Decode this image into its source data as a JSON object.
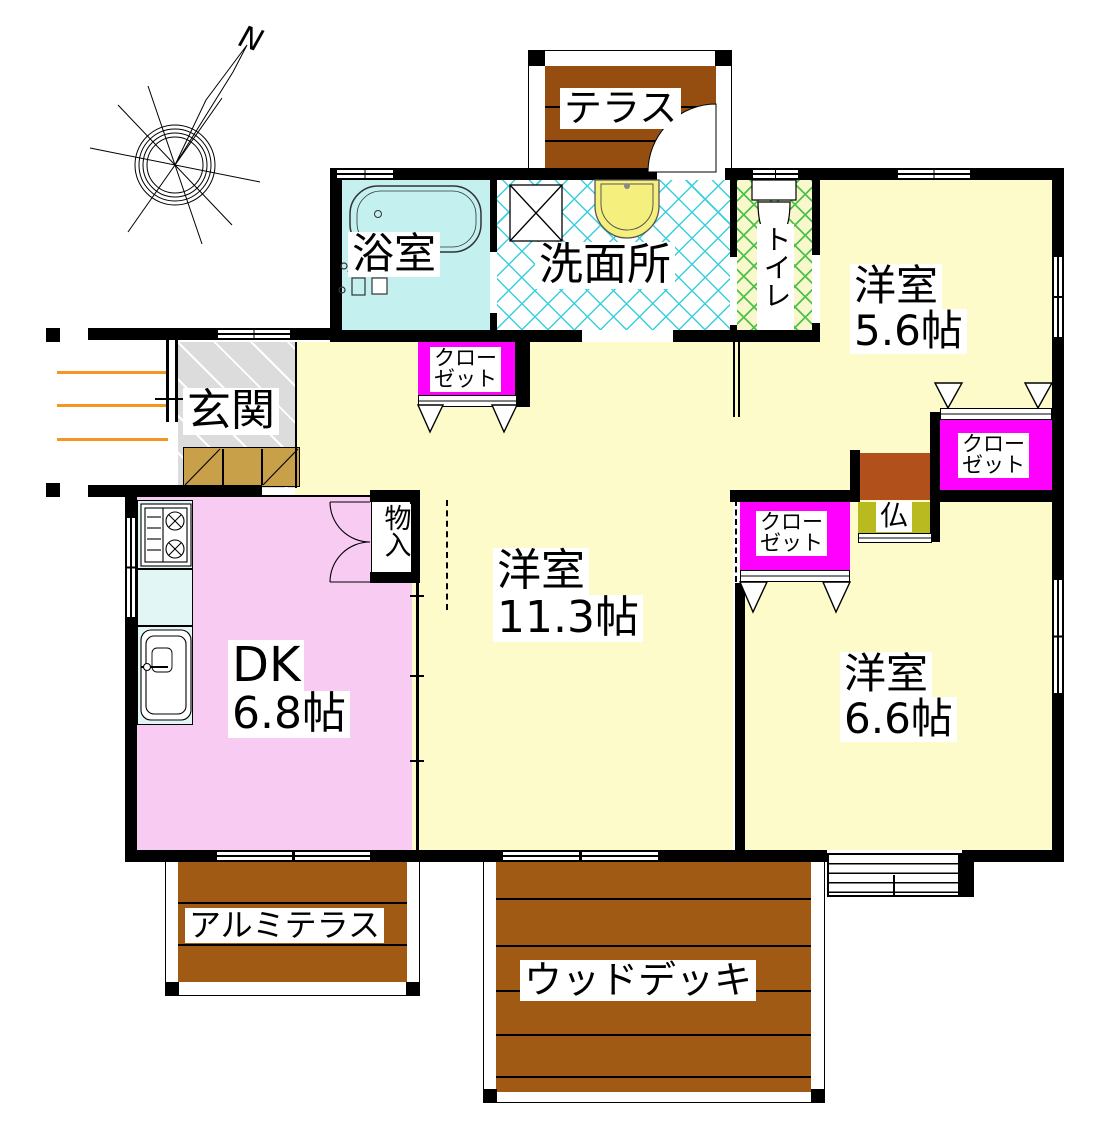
{
  "floorplan": {
    "compass": {
      "north_mark": "N"
    },
    "rooms": {
      "terrace": {
        "label": "テラス"
      },
      "bath": {
        "label": "浴室"
      },
      "washroom": {
        "label": "洗面所"
      },
      "toilet": {
        "label": "トイレ"
      },
      "room56": {
        "name": "洋室",
        "size": "5.6帖"
      },
      "entrance": {
        "label": "玄関"
      },
      "closet_113": {
        "line1": "クロー",
        "line2": "ゼット"
      },
      "closet_56": {
        "line1": "クロー",
        "line2": "ゼット"
      },
      "closet_66": {
        "line1": "クロー",
        "line2": "ゼット"
      },
      "storage": {
        "label": "物入"
      },
      "room113": {
        "name": "洋室",
        "size": "11.3帖"
      },
      "dk": {
        "name": "DK",
        "size": "6.8帖"
      },
      "butsudan": {
        "label": "仏"
      },
      "room66": {
        "name": "洋室",
        "size": "6.6帖"
      },
      "alumi_terrace": {
        "label": "アルミテラス"
      },
      "wood_deck": {
        "label": "ウッドデッキ"
      }
    },
    "colors": {
      "room_yellow": "#FCFBC9",
      "dk_pink": "#F8CBF2",
      "bath_cyan": "#C4F0F0",
      "closet_magenta": "#FF00FF",
      "wood_brown": "#A05A14",
      "terrace_brown": "#964E10",
      "butsudan_olive": "#B9B920",
      "entrance_gray": "#DCDCDC",
      "cabinet_tan": "#C8A04A",
      "kitchen_cyan": "#E2F6F6",
      "approach_orange": "#F59522",
      "hatch_cyan": "#38CFDF",
      "hatch_green": "#4BC34B",
      "wall_black": "#000000"
    }
  }
}
